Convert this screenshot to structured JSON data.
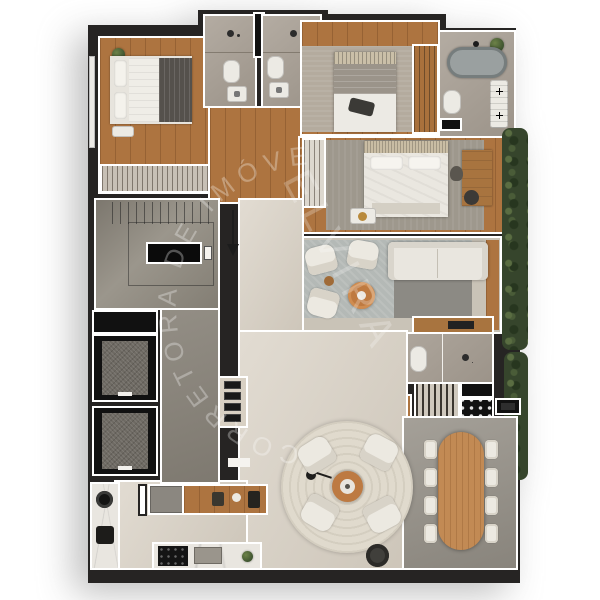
{
  "watermark": {
    "brand": "ELVIRA",
    "arc_text": "CORRETORA DE IMÓVEIS"
  },
  "palette": {
    "background": "#ffffff",
    "wall": "#262423",
    "wall_outline": "#ffffff",
    "wood_floor": "#ad7440",
    "bathroom_tile": "#a9a095",
    "rug_light": "#b4b9b6",
    "rug_dark": "#8c8a84",
    "bedroom_rug": "#b4ab9e",
    "open_floor_beige": "#d8d0c3",
    "terrace_floor": "#98938a",
    "hedge_green": "#36452c",
    "stair_concrete": "#8f8a81",
    "accent_wood": "#bf7a40",
    "dining_wood": "#c28a54",
    "fixture_black": "#111111",
    "furniture_white": "#eceae4",
    "bathtub_gray": "#9aa0a0"
  }
}
